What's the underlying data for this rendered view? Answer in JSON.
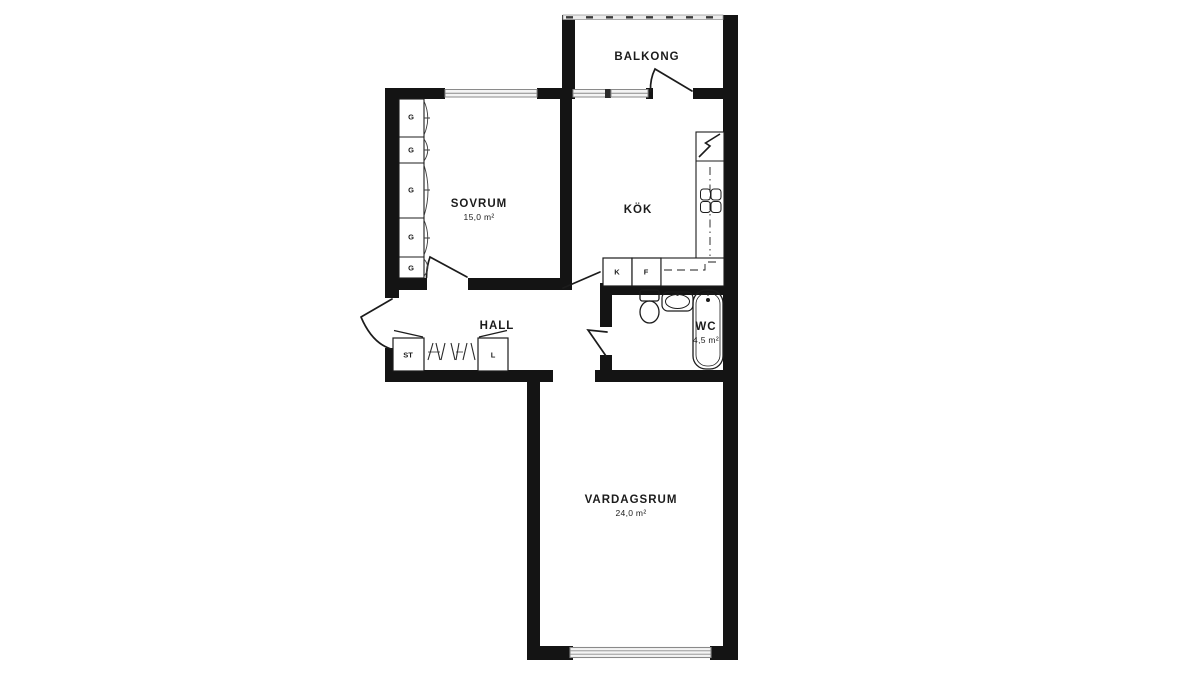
{
  "plan": {
    "type": "apartment-floor-plan",
    "rooms": [
      {
        "id": "balkong",
        "name": "BALKONG",
        "area": ""
      },
      {
        "id": "sovrum",
        "name": "SOVRUM",
        "area": "15,0 m²"
      },
      {
        "id": "kok",
        "name": "KÖK",
        "area": ""
      },
      {
        "id": "hall",
        "name": "HALL",
        "area": ""
      },
      {
        "id": "wc",
        "name": "WC",
        "area": "4,5 m²"
      },
      {
        "id": "vardagsrum",
        "name": "VARDAGSRUM",
        "area": "24,0 m²"
      }
    ],
    "cabinets": {
      "wardrobe_label": "G",
      "cleaning_label": "ST",
      "linen_label": "L",
      "fridge_label": "K",
      "freezer_label": "F"
    },
    "colors": {
      "wall": "#141414",
      "line": "#1c1c1c",
      "window_fill": "#f4f4f4",
      "window_stroke": "#8a8a8a",
      "railing_fill": "#ececec",
      "background": "#ffffff"
    }
  }
}
